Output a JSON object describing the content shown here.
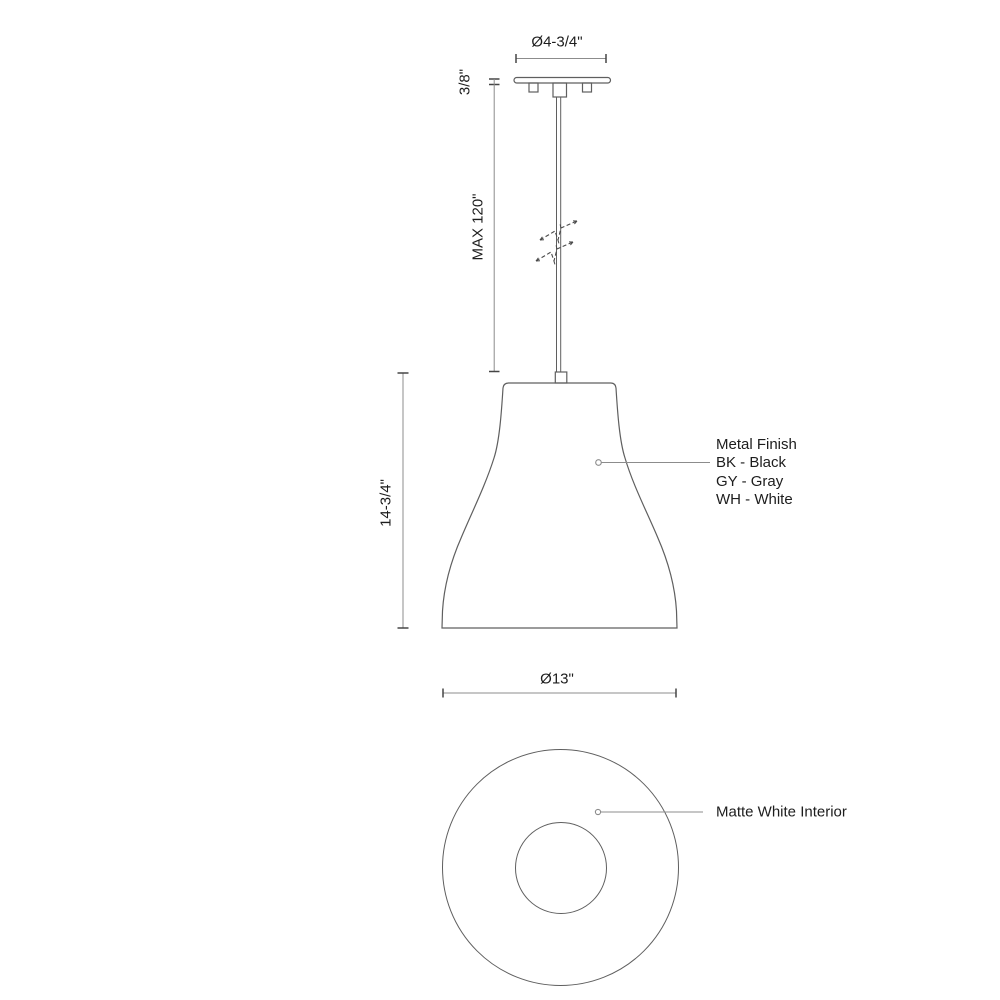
{
  "dimensions": {
    "canopy_diameter": "Ø4-3/4\"",
    "canopy_height": "3/8\"",
    "rod_max_length": "MAX 120\"",
    "shade_height": "14-3/4\"",
    "shade_diameter": "Ø13\""
  },
  "annotations": {
    "metal_finish": {
      "title": "Metal Finish",
      "options": [
        "BK - Black",
        "GY - Gray",
        "WH - White"
      ]
    },
    "interior": "Matte White Interior"
  },
  "colors": {
    "line": "#5f5f5f",
    "dimension_line": "#8c8c8c",
    "tick": "#454545",
    "text": "#1d1d1d",
    "break": "#4a4a4a",
    "background": "#ffffff"
  }
}
